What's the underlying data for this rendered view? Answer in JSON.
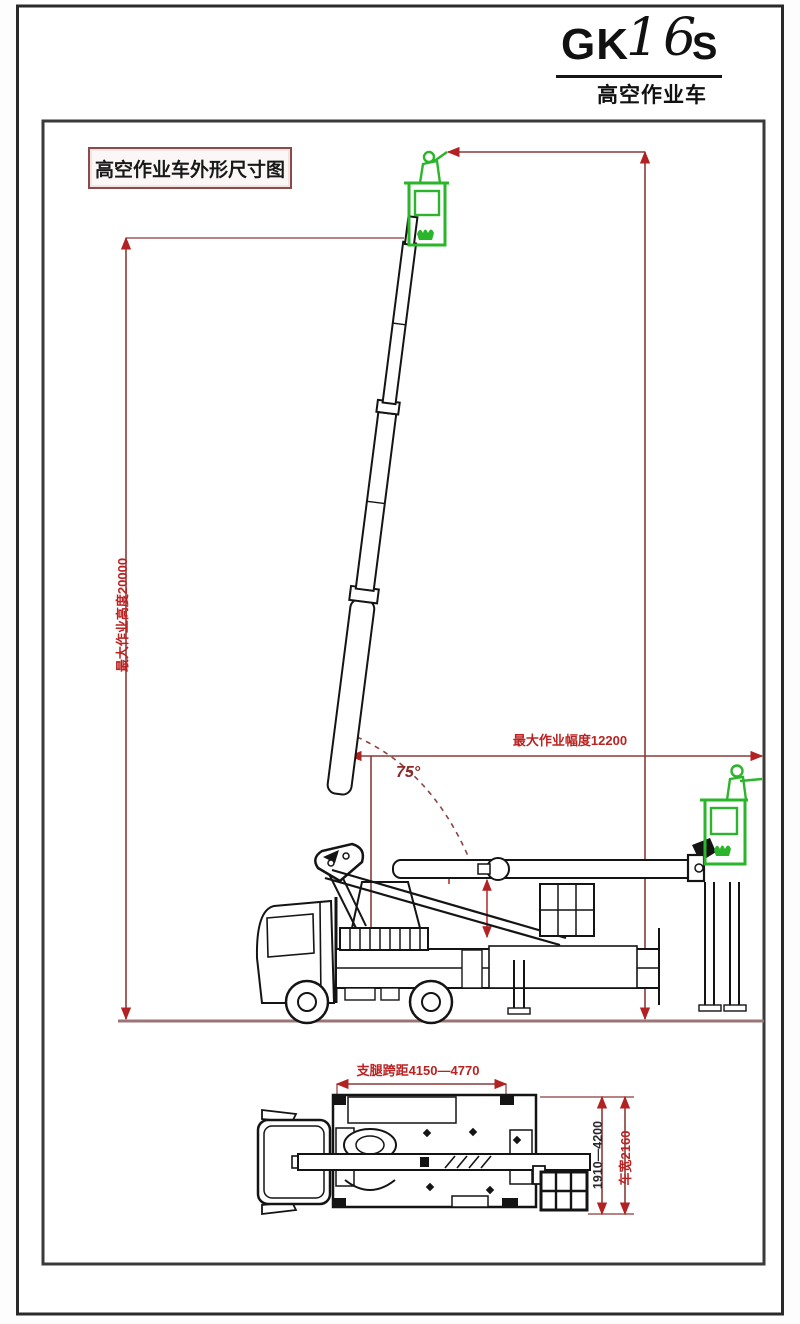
{
  "header": {
    "model": {
      "prefix": "GK",
      "number": "16",
      "suffix": "S"
    },
    "subtitle": "高空作业车"
  },
  "drawing": {
    "title_box_label": "高空作业车外形尺寸图",
    "side_view": {
      "max_working_height_label": "最大作业高度20000",
      "max_working_radius_label": "最大作业幅度12200",
      "boom_angle_label": "75°"
    },
    "plan_view": {
      "outrigger_span_label": "支腿跨距4150—4770",
      "outrigger_width_label": "1910—4200",
      "vehicle_width_label": "车宽2160"
    }
  },
  "colors": {
    "dimension_line": "#8b3a3a",
    "dimension_text": "#bb2222",
    "ground_line": "#9b7575",
    "basket_green": "#2ab52a",
    "drawing_line": "#141414"
  }
}
